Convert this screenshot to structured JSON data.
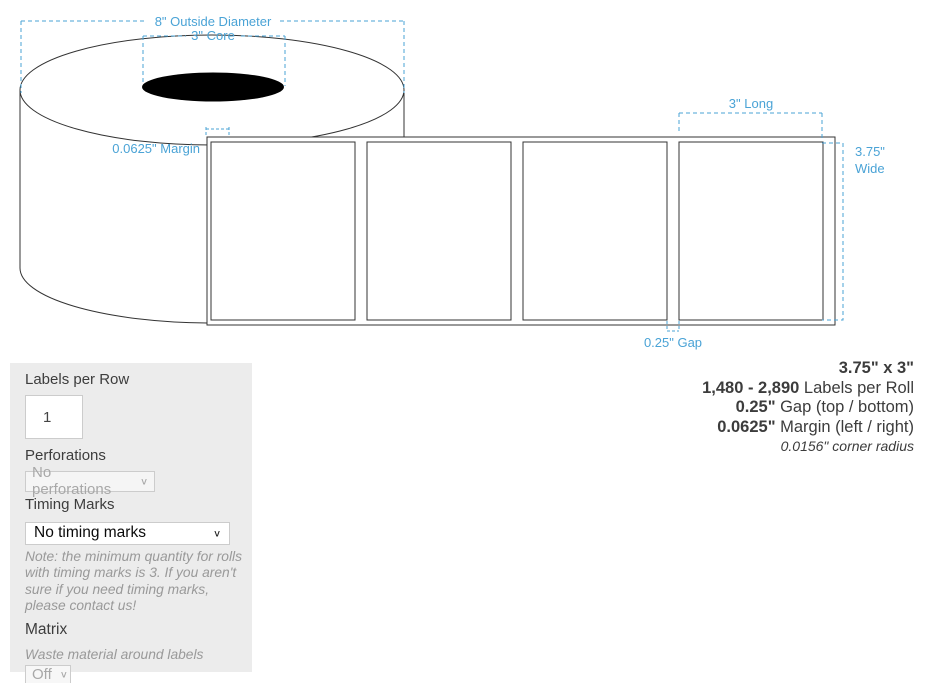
{
  "diagram": {
    "annotations": {
      "outside_diameter": "8\" Outside Diameter",
      "core": "3\" Core",
      "margin": "0.0625\" Margin",
      "long": "3\" Long",
      "wide_line1": "3.75\"",
      "wide_line2": "Wide",
      "gap": "0.25\" Gap"
    },
    "colors": {
      "dimension_blue": "#4aa3d6",
      "outline": "#333333",
      "core_fill": "#000000"
    }
  },
  "panel": {
    "labels_per_row": {
      "label": "Labels per Row",
      "value": "1"
    },
    "perforations": {
      "label": "Perforations",
      "selected": "No perforations"
    },
    "timing_marks": {
      "label": "Timing Marks",
      "selected": "No timing marks",
      "note": "Note: the minimum quantity for rolls with timing marks is 3. If you aren't sure if you need timing marks, please contact us!"
    },
    "matrix": {
      "label": "Matrix",
      "description": "Waste material around labels",
      "selected": "Off"
    }
  },
  "specs": {
    "size": "3.75\" x 3\"",
    "labels_per_roll_value": "1,480 - 2,890",
    "labels_per_roll_text": " Labels per Roll",
    "gap_value": "0.25\"",
    "gap_text": " Gap (top / bottom)",
    "margin_value": "0.0625\"",
    "margin_text": " Margin (left / right)",
    "corner_radius": "0.0156\" corner radius"
  },
  "icons": {
    "chevron": "∨"
  }
}
